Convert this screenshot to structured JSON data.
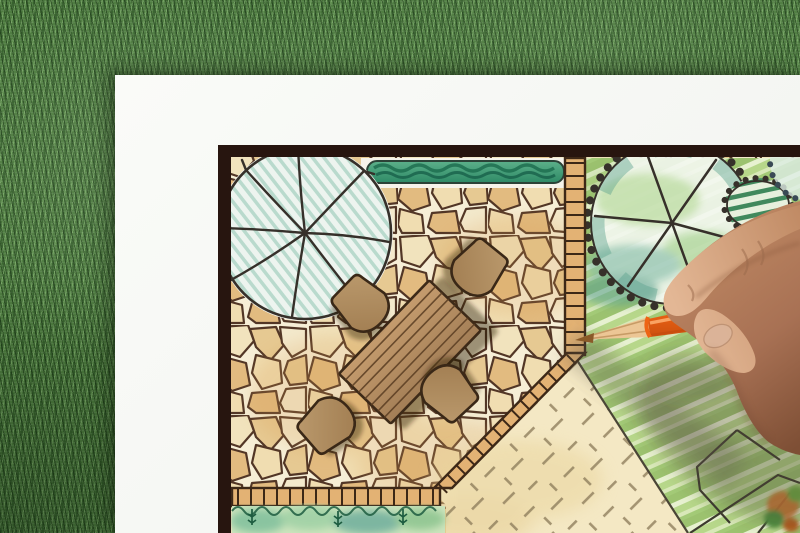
{
  "scene": {
    "description": "Close-up photo of a hand drawing a landscape garden design plan with an orange colored pencil",
    "setting": "white paper sheet lying on a green grass lawn, plan sheet has a dark border frame",
    "plan": {
      "style": "hand-drawn colored-pencil landscape architecture plan, top view",
      "elements": [
        "large round tree symbol with radial branch lines and teal hatching",
        "teal green hedge strip",
        "irregular flagstone patio paving",
        "rectangular wooden dining table with plank lines",
        "four rounded patio chairs",
        "small tile border edging along patio edges",
        "second round tree with scalloped canopy and spokes",
        "dark striped shrub",
        "diagonally striped lawn",
        "gravel area with cross hatch marks",
        "planting bed with ferns and watercolor washes",
        "angular stepping path lines",
        "orange flowering shrub in corner"
      ]
    },
    "hand": {
      "holding": "orange colored pencil, sharpened wooden tip",
      "position": "entering from the right, pencil tip touching the patio tile-border corner"
    },
    "palette": {
      "grass": "#4c7a3e",
      "paper": "#fafbf8",
      "frame": "#27150f",
      "grout": "#f6eed6",
      "stoneLine": "#523626",
      "stoneA": "#f1e3bd",
      "stoneB": "#e6c992",
      "stoneC": "#f3e9cc",
      "stoneD": "#e2bb80",
      "stoneE": "#f0ddb1",
      "tile": "#e3b274",
      "tileLine": "#3d2817",
      "hedgeLight": "#5cb08a",
      "hedgeDark": "#2e8a66",
      "hedgeInk": "#1f6e50",
      "treeFill": "#edf4ef",
      "treeHatch": "#b9dacd",
      "inkLine": "#36302a",
      "lawnBase": "#d3e5aa",
      "lawnStripeDark": "#9cc26f",
      "lawnStripeMid": "#b7d78a",
      "lawnStripeLight": "#e7f1d0",
      "sand": "#f4e8c4",
      "sandMark": "#8d7c5b",
      "shrubStripe": "#2f7d4f",
      "bedBase": "#cde4bd",
      "fern": "#1d5c40",
      "wood": "#c59c6e",
      "woodDark": "#a37e56",
      "chair": "#bb9a6d",
      "chairDark": "#a07c50",
      "pencilOrange": "#ee6414",
      "pencilOrangeLight": "#ff9440",
      "pencilOrangeDark": "#c84e0e",
      "pencilWood": "#ecc695",
      "pencilCore": "#8a5a28",
      "skinLight": "#e3b795",
      "skinMid": "#c08a64",
      "skinDark": "#8a5a3c"
    }
  }
}
